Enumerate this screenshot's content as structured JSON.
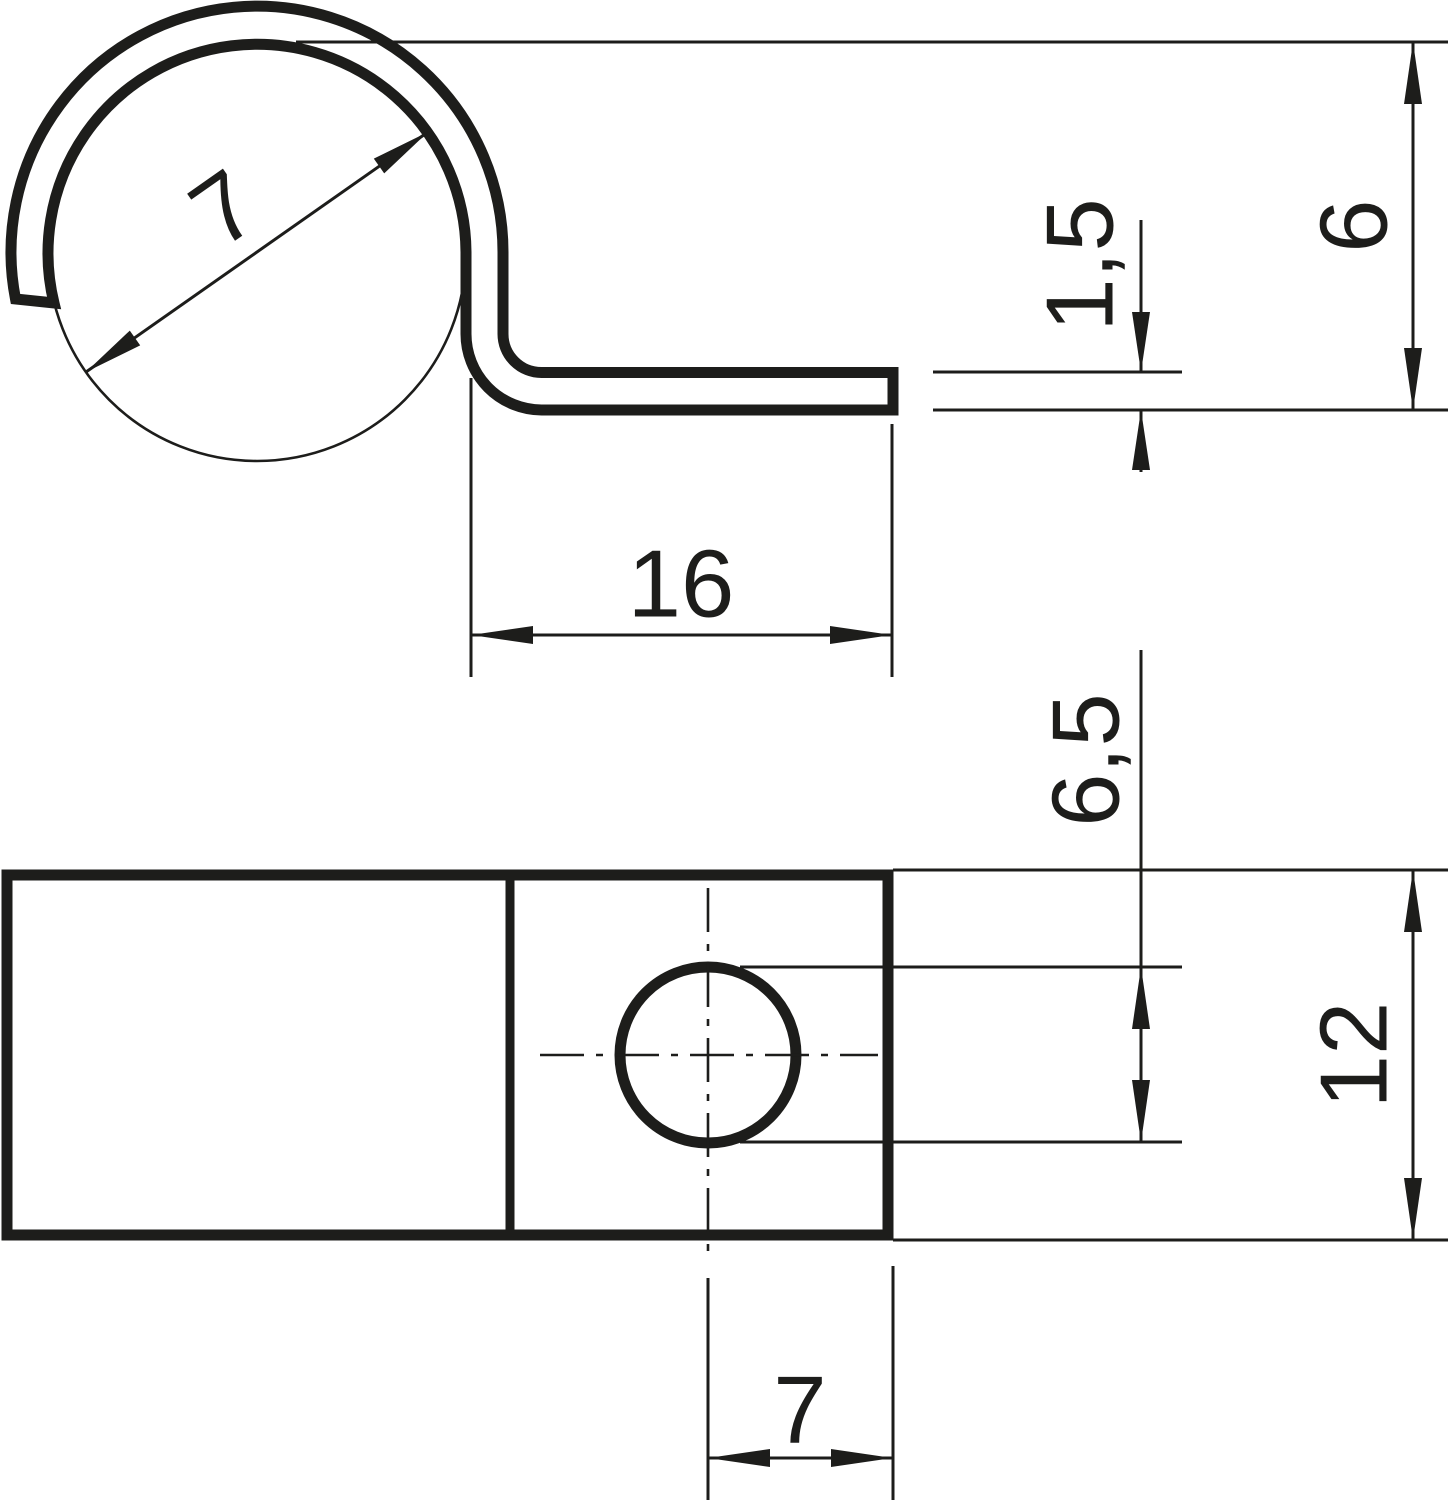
{
  "page": {
    "background_color": "#ffffff",
    "line_color": "#1d1d1b"
  },
  "drawing": {
    "type": "technical-dimension-drawing",
    "views": {
      "side_profile": {
        "dimensions": {
          "cable_diameter": "7",
          "overall_height": "6",
          "material_thickness": "1,5",
          "tab_length": "16"
        }
      },
      "plan": {
        "dimensions": {
          "hole_diameter": "6,5",
          "clip_width": "12",
          "hole_center_offset": "7"
        }
      }
    }
  }
}
